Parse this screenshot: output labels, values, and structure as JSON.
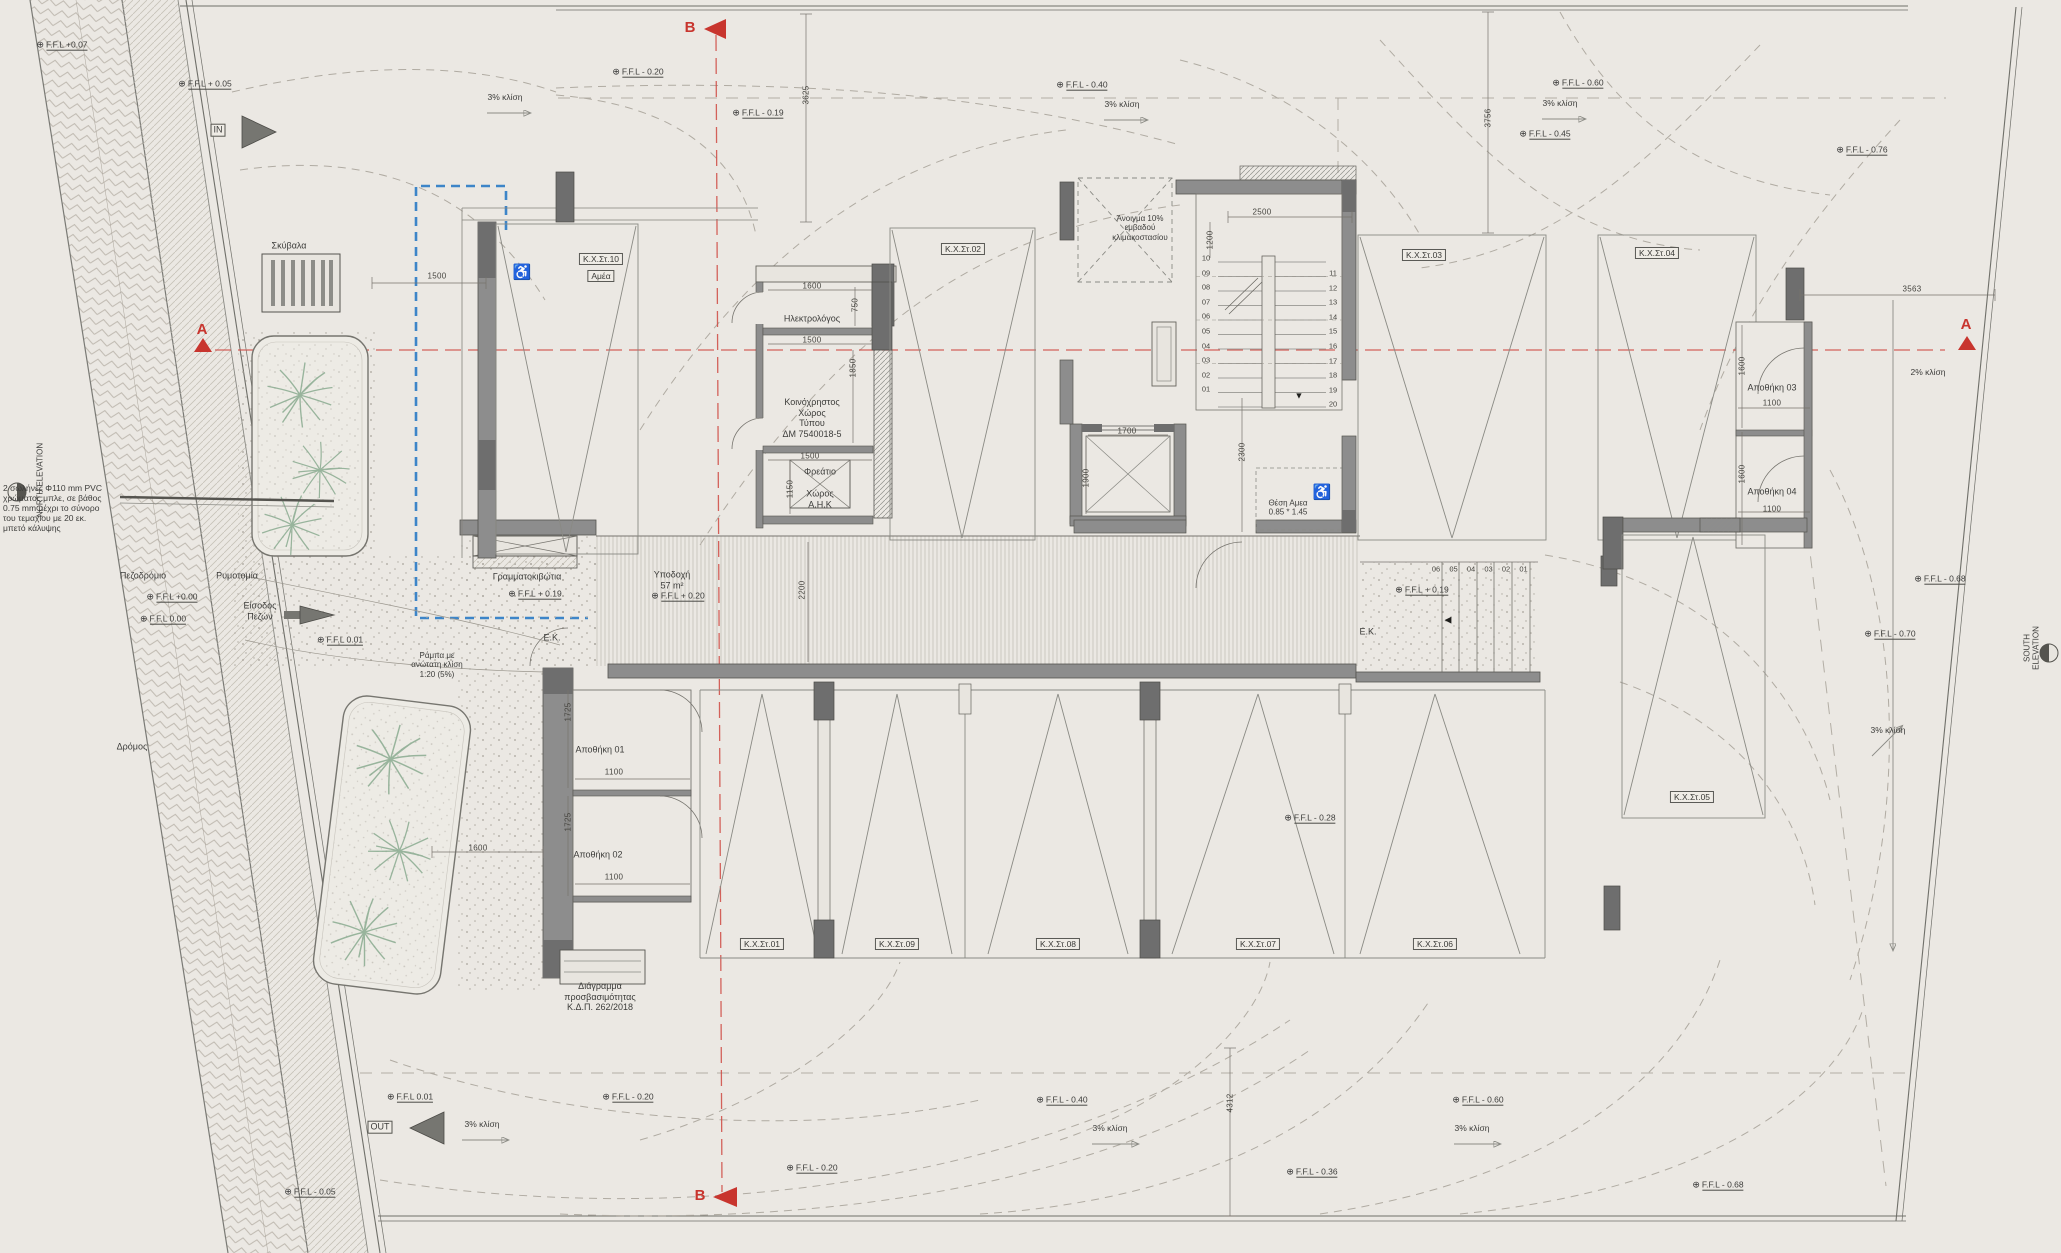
{
  "symbols": {
    "level_marker": "⊕",
    "stair_down_arrow": "▼",
    "steps_arrow": "◀",
    "wheelchair": "♿"
  },
  "colors": {
    "paper": "#ebe8e3",
    "section_line": "#cf4a43",
    "guide_blue": "#3d85c8",
    "wall": "#8d8d8d",
    "wall_dark": "#6e6e6e",
    "plant_green": "#8aab90"
  },
  "stairs": {
    "flight_a_numbers": [
      "10",
      "09",
      "08",
      "07",
      "06",
      "05",
      "04",
      "03",
      "02",
      "01"
    ],
    "flight_b_numbers": [
      "11",
      "12",
      "13",
      "14",
      "15",
      "16",
      "17",
      "18",
      "19",
      "20"
    ],
    "exterior_step_numbers": [
      "06",
      "05",
      "04",
      "03",
      "02",
      "01"
    ]
  },
  "labels": [
    {
      "n": "ffl-top-left",
      "k": "lvl",
      "t": "F.F.L +0.07",
      "x": 62,
      "y": 45
    },
    {
      "n": "ffl-top-left-2",
      "k": "lvl",
      "t": "F.F.L + 0.05",
      "x": 205,
      "y": 84
    },
    {
      "n": "ffl-top-1",
      "k": "lvl",
      "t": "F.F.L - 0.20",
      "x": 638,
      "y": 72
    },
    {
      "n": "ffl-top-2",
      "k": "lvl",
      "t": "F.F.L - 0.19",
      "x": 758,
      "y": 113
    },
    {
      "n": "ffl-top-3",
      "k": "lvl",
      "t": "F.F.L - 0.40",
      "x": 1082,
      "y": 85
    },
    {
      "n": "ffl-top-4",
      "k": "lvl",
      "t": "F.F.L - 0.60",
      "x": 1578,
      "y": 83
    },
    {
      "n": "ffl-top-5",
      "k": "lvl",
      "t": "F.F.L - 0.45",
      "x": 1545,
      "y": 134
    },
    {
      "n": "ffl-top-right",
      "k": "lvl",
      "t": "F.F.L - 0.76",
      "x": 1862,
      "y": 150
    },
    {
      "n": "ffl-west-1",
      "k": "lvl",
      "t": "F.F.L +0.00",
      "x": 172,
      "y": 597
    },
    {
      "n": "ffl-west-2",
      "k": "lvl",
      "t": "F.F.L  0.00",
      "x": 163,
      "y": 619
    },
    {
      "n": "ffl-west-3",
      "k": "lvl",
      "t": "F.F.L  0.01",
      "x": 340,
      "y": 640
    },
    {
      "n": "ffl-lobby-1",
      "k": "lvl",
      "t": "F.F.L + 0.19",
      "x": 535,
      "y": 594
    },
    {
      "n": "ffl-lobby-2",
      "k": "lvl",
      "t": "F.F.L + 0.20",
      "x": 678,
      "y": 596
    },
    {
      "n": "ffl-lobby-3",
      "k": "lvl",
      "t": "F.F.L + 0.19",
      "x": 1422,
      "y": 590
    },
    {
      "n": "ffl-mid-right",
      "k": "lvl",
      "t": "F.F.L - 0.28",
      "x": 1310,
      "y": 818
    },
    {
      "n": "ffl-east-1",
      "k": "lvl",
      "t": "F.F.L - 0.68",
      "x": 1940,
      "y": 579
    },
    {
      "n": "ffl-east-2",
      "k": "lvl",
      "t": "F.F.L - 0.70",
      "x": 1890,
      "y": 634
    },
    {
      "n": "ffl-bottom-1",
      "k": "lvl",
      "t": "F.F.L  0.01",
      "x": 410,
      "y": 1097
    },
    {
      "n": "ffl-bottom-2",
      "k": "lvl",
      "t": "F.F.L - 0.05",
      "x": 310,
      "y": 1192
    },
    {
      "n": "ffl-bottom-3",
      "k": "lvl",
      "t": "F.F.L - 0.20",
      "x": 628,
      "y": 1097
    },
    {
      "n": "ffl-bottom-4",
      "k": "lvl",
      "t": "F.F.L - 0.20",
      "x": 812,
      "y": 1168
    },
    {
      "n": "ffl-bottom-5",
      "k": "lvl",
      "t": "F.F.L - 0.40",
      "x": 1062,
      "y": 1100
    },
    {
      "n": "ffl-bottom-6",
      "k": "lvl",
      "t": "F.F.L - 0.36",
      "x": 1312,
      "y": 1172
    },
    {
      "n": "ffl-bottom-7",
      "k": "lvl",
      "t": "F.F.L - 0.60",
      "x": 1478,
      "y": 1100
    },
    {
      "n": "ffl-bottom-8",
      "k": "lvl",
      "t": "F.F.L - 0.68",
      "x": 1718,
      "y": 1185
    },
    {
      "n": "slope-top-1",
      "k": "slope",
      "t": "3% κλίση",
      "x": 505,
      "y": 97
    },
    {
      "n": "slope-top-2",
      "k": "slope",
      "t": "3% κλίση",
      "x": 1122,
      "y": 104
    },
    {
      "n": "slope-top-3",
      "k": "slope",
      "t": "3% κλίση",
      "x": 1560,
      "y": 103
    },
    {
      "n": "slope-east-1",
      "k": "slope",
      "t": "2% κλίση",
      "x": 1928,
      "y": 372
    },
    {
      "n": "slope-east-2",
      "k": "slope",
      "t": "3% κλίση",
      "x": 1888,
      "y": 730
    },
    {
      "n": "slope-bottom-1",
      "k": "slope",
      "t": "3% κλίση",
      "x": 482,
      "y": 1124
    },
    {
      "n": "slope-bottom-2",
      "k": "slope",
      "t": "3% κλίση",
      "x": 1110,
      "y": 1128
    },
    {
      "n": "slope-bottom-3",
      "k": "slope",
      "t": "3% κλίση",
      "x": 1472,
      "y": 1128
    },
    {
      "n": "stall-10",
      "k": "stall",
      "t": "K.X.Στ.10",
      "x": 601,
      "y": 259
    },
    {
      "n": "stall-10-amea",
      "k": "stall",
      "t": "Αμέα",
      "x": 601,
      "y": 276
    },
    {
      "n": "stall-02",
      "k": "stall",
      "t": "K.X.Στ.02",
      "x": 963,
      "y": 249
    },
    {
      "n": "stall-03",
      "k": "stall",
      "t": "K.X.Στ.03",
      "x": 1424,
      "y": 255
    },
    {
      "n": "stall-04",
      "k": "stall",
      "t": "K.X.Στ.04",
      "x": 1657,
      "y": 253
    },
    {
      "n": "stall-01",
      "k": "stall",
      "t": "K.X.Στ.01",
      "x": 762,
      "y": 944
    },
    {
      "n": "stall-09",
      "k": "stall",
      "t": "K.X.Στ.09",
      "x": 897,
      "y": 944
    },
    {
      "n": "stall-08",
      "k": "stall",
      "t": "K.X.Στ.08",
      "x": 1058,
      "y": 944
    },
    {
      "n": "stall-07",
      "k": "stall",
      "t": "K.X.Στ.07",
      "x": 1258,
      "y": 944
    },
    {
      "n": "stall-06",
      "k": "stall",
      "t": "K.X.Στ.06",
      "x": 1435,
      "y": 944
    },
    {
      "n": "stall-05",
      "k": "stall",
      "t": "K.X.Στ.05",
      "x": 1692,
      "y": 797
    },
    {
      "n": "room-garbage",
      "k": "room",
      "t": "Σκύβαλα",
      "x": 289,
      "y": 246
    },
    {
      "n": "room-electrician",
      "k": "room",
      "t": "Ηλεκτρολόγος",
      "x": 812,
      "y": 319
    },
    {
      "n": "room-common",
      "k": "room",
      "t": "Κοινόχρηστος\nΧώρος\nΤύπου\nΔΜ 7540018-5",
      "x": 812,
      "y": 418
    },
    {
      "n": "room-shaft",
      "k": "room",
      "t": "Φρεάτιο",
      "x": 820,
      "y": 472
    },
    {
      "n": "room-ahk",
      "k": "room",
      "t": "Χώρος\nΑ.Η.Κ",
      "x": 820,
      "y": 499
    },
    {
      "n": "room-mailboxes",
      "k": "room",
      "t": "Γραμματοκιβώτια",
      "x": 527,
      "y": 577
    },
    {
      "n": "room-reception",
      "k": "room",
      "t": "Υποδοχή\n57 m²",
      "x": 672,
      "y": 580
    },
    {
      "n": "room-ek-left",
      "k": "room",
      "t": "E.K.",
      "x": 552,
      "y": 638
    },
    {
      "n": "room-ek-right",
      "k": "room",
      "t": "E.K.",
      "x": 1368,
      "y": 632
    },
    {
      "n": "room-storage-01",
      "k": "room",
      "t": "Αποθήκη 01",
      "x": 600,
      "y": 750
    },
    {
      "n": "room-storage-02",
      "k": "room",
      "t": "Αποθήκη 02",
      "x": 598,
      "y": 855
    },
    {
      "n": "room-storage-03",
      "k": "room",
      "t": "Αποθήκη 03",
      "x": 1772,
      "y": 388
    },
    {
      "n": "room-storage-04",
      "k": "room",
      "t": "Αποθήκη 04",
      "x": 1772,
      "y": 492
    },
    {
      "n": "note-disabled-spot",
      "k": "tiny",
      "t": "Θέση Αμεα\n0.85 * 1.45",
      "x": 1288,
      "y": 508
    },
    {
      "n": "note-stair-opening",
      "k": "tiny",
      "t": "Άνοιγμα 10%\nεμβαδού\nκλιμακοστασίου",
      "x": 1140,
      "y": 228
    },
    {
      "n": "note-accessibility",
      "k": "room",
      "t": "Διάγραμμα\nπροσβασιμότητας\nΚ.Δ.Π. 262/2018",
      "x": 600,
      "y": 997
    },
    {
      "n": "note-ramp",
      "k": "tiny",
      "t": "Ράμπα με\nανώτατη κλίση\n1:20 (5%)",
      "x": 437,
      "y": 665
    },
    {
      "n": "label-sidewalk",
      "k": "room",
      "t": "Πεζοδρόμιο",
      "x": 143,
      "y": 576
    },
    {
      "n": "label-street-line",
      "k": "room",
      "t": "Ρυμοτομία",
      "x": 237,
      "y": 576
    },
    {
      "n": "label-ped-entrance",
      "k": "room",
      "t": "Είσοδος\nΠεζών",
      "x": 260,
      "y": 611
    },
    {
      "n": "label-road",
      "k": "room",
      "t": "Δρόμος",
      "x": 132,
      "y": 747
    },
    {
      "n": "note-pvc-pipes",
      "k": "note",
      "t": "2 σωλήνες Φ110 mm PVC\nχρώματος μπλε, σε βάθος\n0.75 mm μέχρι το σύνορο\nτου τεμαχίου με 20 εκ.\nμπετό κάλυψης",
      "x": 3,
      "y": 508
    },
    {
      "n": "label-north-elevation",
      "k": "tiny",
      "t": "NORTH ELEVATION",
      "x": 40,
      "y": 480,
      "r": 1
    },
    {
      "n": "label-south-elevation",
      "k": "tiny",
      "t": "SOUTH ELEVATION",
      "x": 2032,
      "y": 648,
      "r": 1
    },
    {
      "n": "marker-in",
      "k": "boxed",
      "t": "IN",
      "x": 218,
      "y": 130
    },
    {
      "n": "marker-out",
      "k": "boxed",
      "t": "OUT",
      "x": 380,
      "y": 1127
    },
    {
      "n": "section-b-top",
      "k": "sec",
      "t": "B",
      "x": 690,
      "y": 28
    },
    {
      "n": "section-b-bottom",
      "k": "sec",
      "t": "B",
      "x": 700,
      "y": 1196
    },
    {
      "n": "section-a-left",
      "k": "sec",
      "t": "A",
      "x": 202,
      "y": 330
    },
    {
      "n": "section-a-right",
      "k": "sec",
      "t": "A",
      "x": 1966,
      "y": 325
    },
    {
      "n": "stair-down-arrow",
      "k": "glyph",
      "t": "▼",
      "x": 1299,
      "y": 396
    },
    {
      "n": "steps-direction-arrow",
      "k": "glyph",
      "t": "◀",
      "x": 1448,
      "y": 620
    },
    {
      "n": "wheelchair-stall10",
      "k": "wc",
      "t": "♿",
      "x": 522,
      "y": 273
    },
    {
      "n": "wheelchair-core",
      "k": "wc",
      "t": "♿",
      "x": 1322,
      "y": 493
    },
    {
      "n": "dim-1500-a",
      "k": "dim",
      "t": "1500",
      "x": 437,
      "y": 276
    },
    {
      "n": "dim-3625",
      "k": "dim",
      "t": "3625",
      "x": 806,
      "y": 95,
      "r": 1
    },
    {
      "n": "dim-3756",
      "k": "dim",
      "t": "3756",
      "x": 1488,
      "y": 118,
      "r": 1
    },
    {
      "n": "dim-3563",
      "k": "dim",
      "t": "3563",
      "x": 1912,
      "y": 289
    },
    {
      "n": "dim-2500",
      "k": "dim",
      "t": "2500",
      "x": 1262,
      "y": 212
    },
    {
      "n": "dim-1200",
      "k": "dim",
      "t": "1200",
      "x": 1210,
      "y": 240,
      "r": 1
    },
    {
      "n": "dim-1600-el",
      "k": "dim",
      "t": "1600",
      "x": 812,
      "y": 286
    },
    {
      "n": "dim-750",
      "k": "dim",
      "t": "750",
      "x": 855,
      "y": 305,
      "r": 1
    },
    {
      "n": "dim-1500-b",
      "k": "dim",
      "t": "1500",
      "x": 812,
      "y": 340
    },
    {
      "n": "dim-1850",
      "k": "dim",
      "t": "1850",
      "x": 853,
      "y": 368,
      "r": 1
    },
    {
      "n": "dim-1500-c",
      "k": "dim",
      "t": "1500",
      "x": 810,
      "y": 456
    },
    {
      "n": "dim-1150",
      "k": "dim",
      "t": "1150",
      "x": 790,
      "y": 489,
      "r": 1
    },
    {
      "n": "dim-1700",
      "k": "dim",
      "t": "1700",
      "x": 1127,
      "y": 431
    },
    {
      "n": "dim-1900",
      "k": "dim",
      "t": "1900",
      "x": 1086,
      "y": 478,
      "r": 1
    },
    {
      "n": "dim-2300",
      "k": "dim",
      "t": "2300",
      "x": 1242,
      "y": 452,
      "r": 1
    },
    {
      "n": "dim-2200",
      "k": "dim",
      "t": "2200",
      "x": 802,
      "y": 590,
      "r": 1
    },
    {
      "n": "dim-1725-a",
      "k": "dim",
      "t": "1725",
      "x": 568,
      "y": 712,
      "r": 1
    },
    {
      "n": "dim-1100-a",
      "k": "dim",
      "t": "1100",
      "x": 614,
      "y": 772
    },
    {
      "n": "dim-1725-b",
      "k": "dim",
      "t": "1725",
      "x": 568,
      "y": 822,
      "r": 1
    },
    {
      "n": "dim-1100-b",
      "k": "dim",
      "t": "1100",
      "x": 614,
      "y": 877
    },
    {
      "n": "dim-1600-pl",
      "k": "dim",
      "t": "1600",
      "x": 478,
      "y": 848
    },
    {
      "n": "dim-1600-r1",
      "k": "dim",
      "t": "1600",
      "x": 1742,
      "y": 366,
      "r": 1
    },
    {
      "n": "dim-1100-r1",
      "k": "dim",
      "t": "1100",
      "x": 1772,
      "y": 403
    },
    {
      "n": "dim-1600-r2",
      "k": "dim",
      "t": "1600",
      "x": 1742,
      "y": 474,
      "r": 1
    },
    {
      "n": "dim-1100-r2",
      "k": "dim",
      "t": "1100",
      "x": 1772,
      "y": 509
    },
    {
      "n": "dim-4312",
      "k": "dim",
      "t": "4312",
      "x": 1230,
      "y": 1103,
      "r": 1
    }
  ]
}
